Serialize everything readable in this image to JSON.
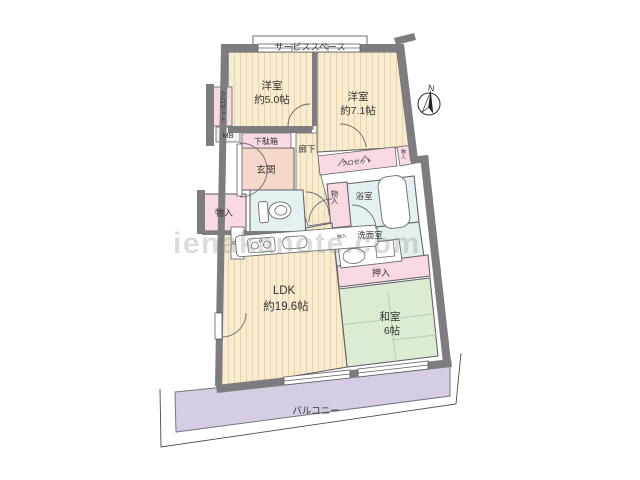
{
  "floor_plan": {
    "watermark": "ienakanote.com",
    "compass_label": "N",
    "service_space_label": "サービススペース",
    "rooms": {
      "western_room_small": {
        "name": "洋室",
        "size": "約5.0帖"
      },
      "western_room_large": {
        "name": "洋室",
        "size": "約7.1帖"
      },
      "ldk": {
        "name": "LDK",
        "size": "約19.6帖"
      },
      "japanese_room": {
        "name": "和室",
        "size": "6帖"
      },
      "balcony_label": "バルコニー",
      "entrance_label": "玄関",
      "hallway_label": "廊下",
      "shoe_cabinet_label": "下駄箱",
      "closet_left_label": "クロゼット",
      "closet_right_label": "クロゼット",
      "meter_box_label": "MB",
      "storage_left_label": "物入",
      "storage_right_label": "物入",
      "storage_center_label": "物入",
      "storage_small_label": "物入",
      "bathroom_label": "浴室",
      "washroom_label": "洗面室",
      "futon_closet_label": "押入"
    },
    "colors": {
      "wall_gray": "#7d7d81",
      "flooring_beige": "#f7ecd2",
      "tatami_green": "#dcecd2",
      "closet_pink": "#f9d9e2",
      "entrance_salmon": "#f5d8c9",
      "wet_area_blue": "#e4f1f3",
      "washroom_blue": "#e3f0ee",
      "balcony_purple": "#d6cde4",
      "meter_box_gray": "#f0f0f0"
    }
  }
}
